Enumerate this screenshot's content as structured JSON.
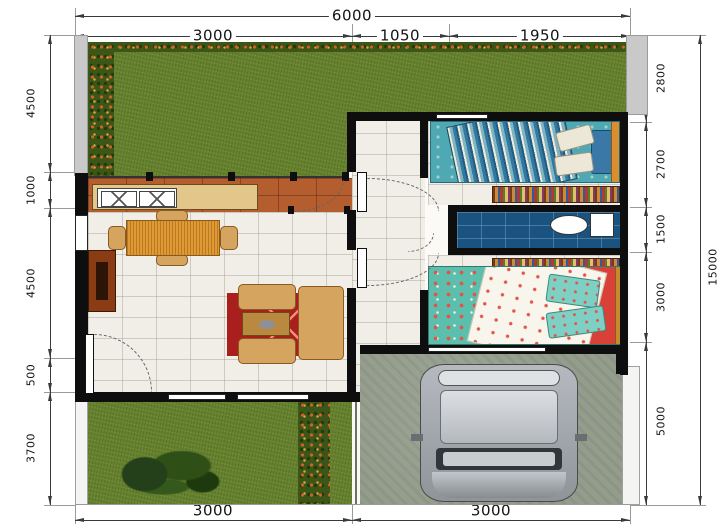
{
  "dims": {
    "top": {
      "total": "6000",
      "segments": [
        "3000",
        "1050",
        "1950"
      ]
    },
    "bottom": {
      "segments": [
        "3000",
        "3000"
      ]
    },
    "left": {
      "segments": [
        "4500",
        "1000",
        "4500",
        "500",
        "3700"
      ]
    },
    "right": {
      "total": "15000",
      "segments": [
        "2800",
        "2700",
        "1500",
        "3000",
        "5000"
      ]
    }
  },
  "colors": {
    "grass": "#66812e",
    "grass-dark": "#3c5618",
    "flower": "#cf6328",
    "terrace": "#b45e2f",
    "counter": "#e3c689",
    "floor": "#f0eee7",
    "wall": "#0e0e0e",
    "fence": "#c9c9c9",
    "bath": "#1b5380",
    "carpet": "#a81f1d",
    "sofa": "#d5a45f",
    "wood": "#e09a33",
    "cabinet": "#8a3c14",
    "bed-teal": "#4fa9b4",
    "concrete": "#949d8c",
    "car-body": "#b6bac0"
  }
}
